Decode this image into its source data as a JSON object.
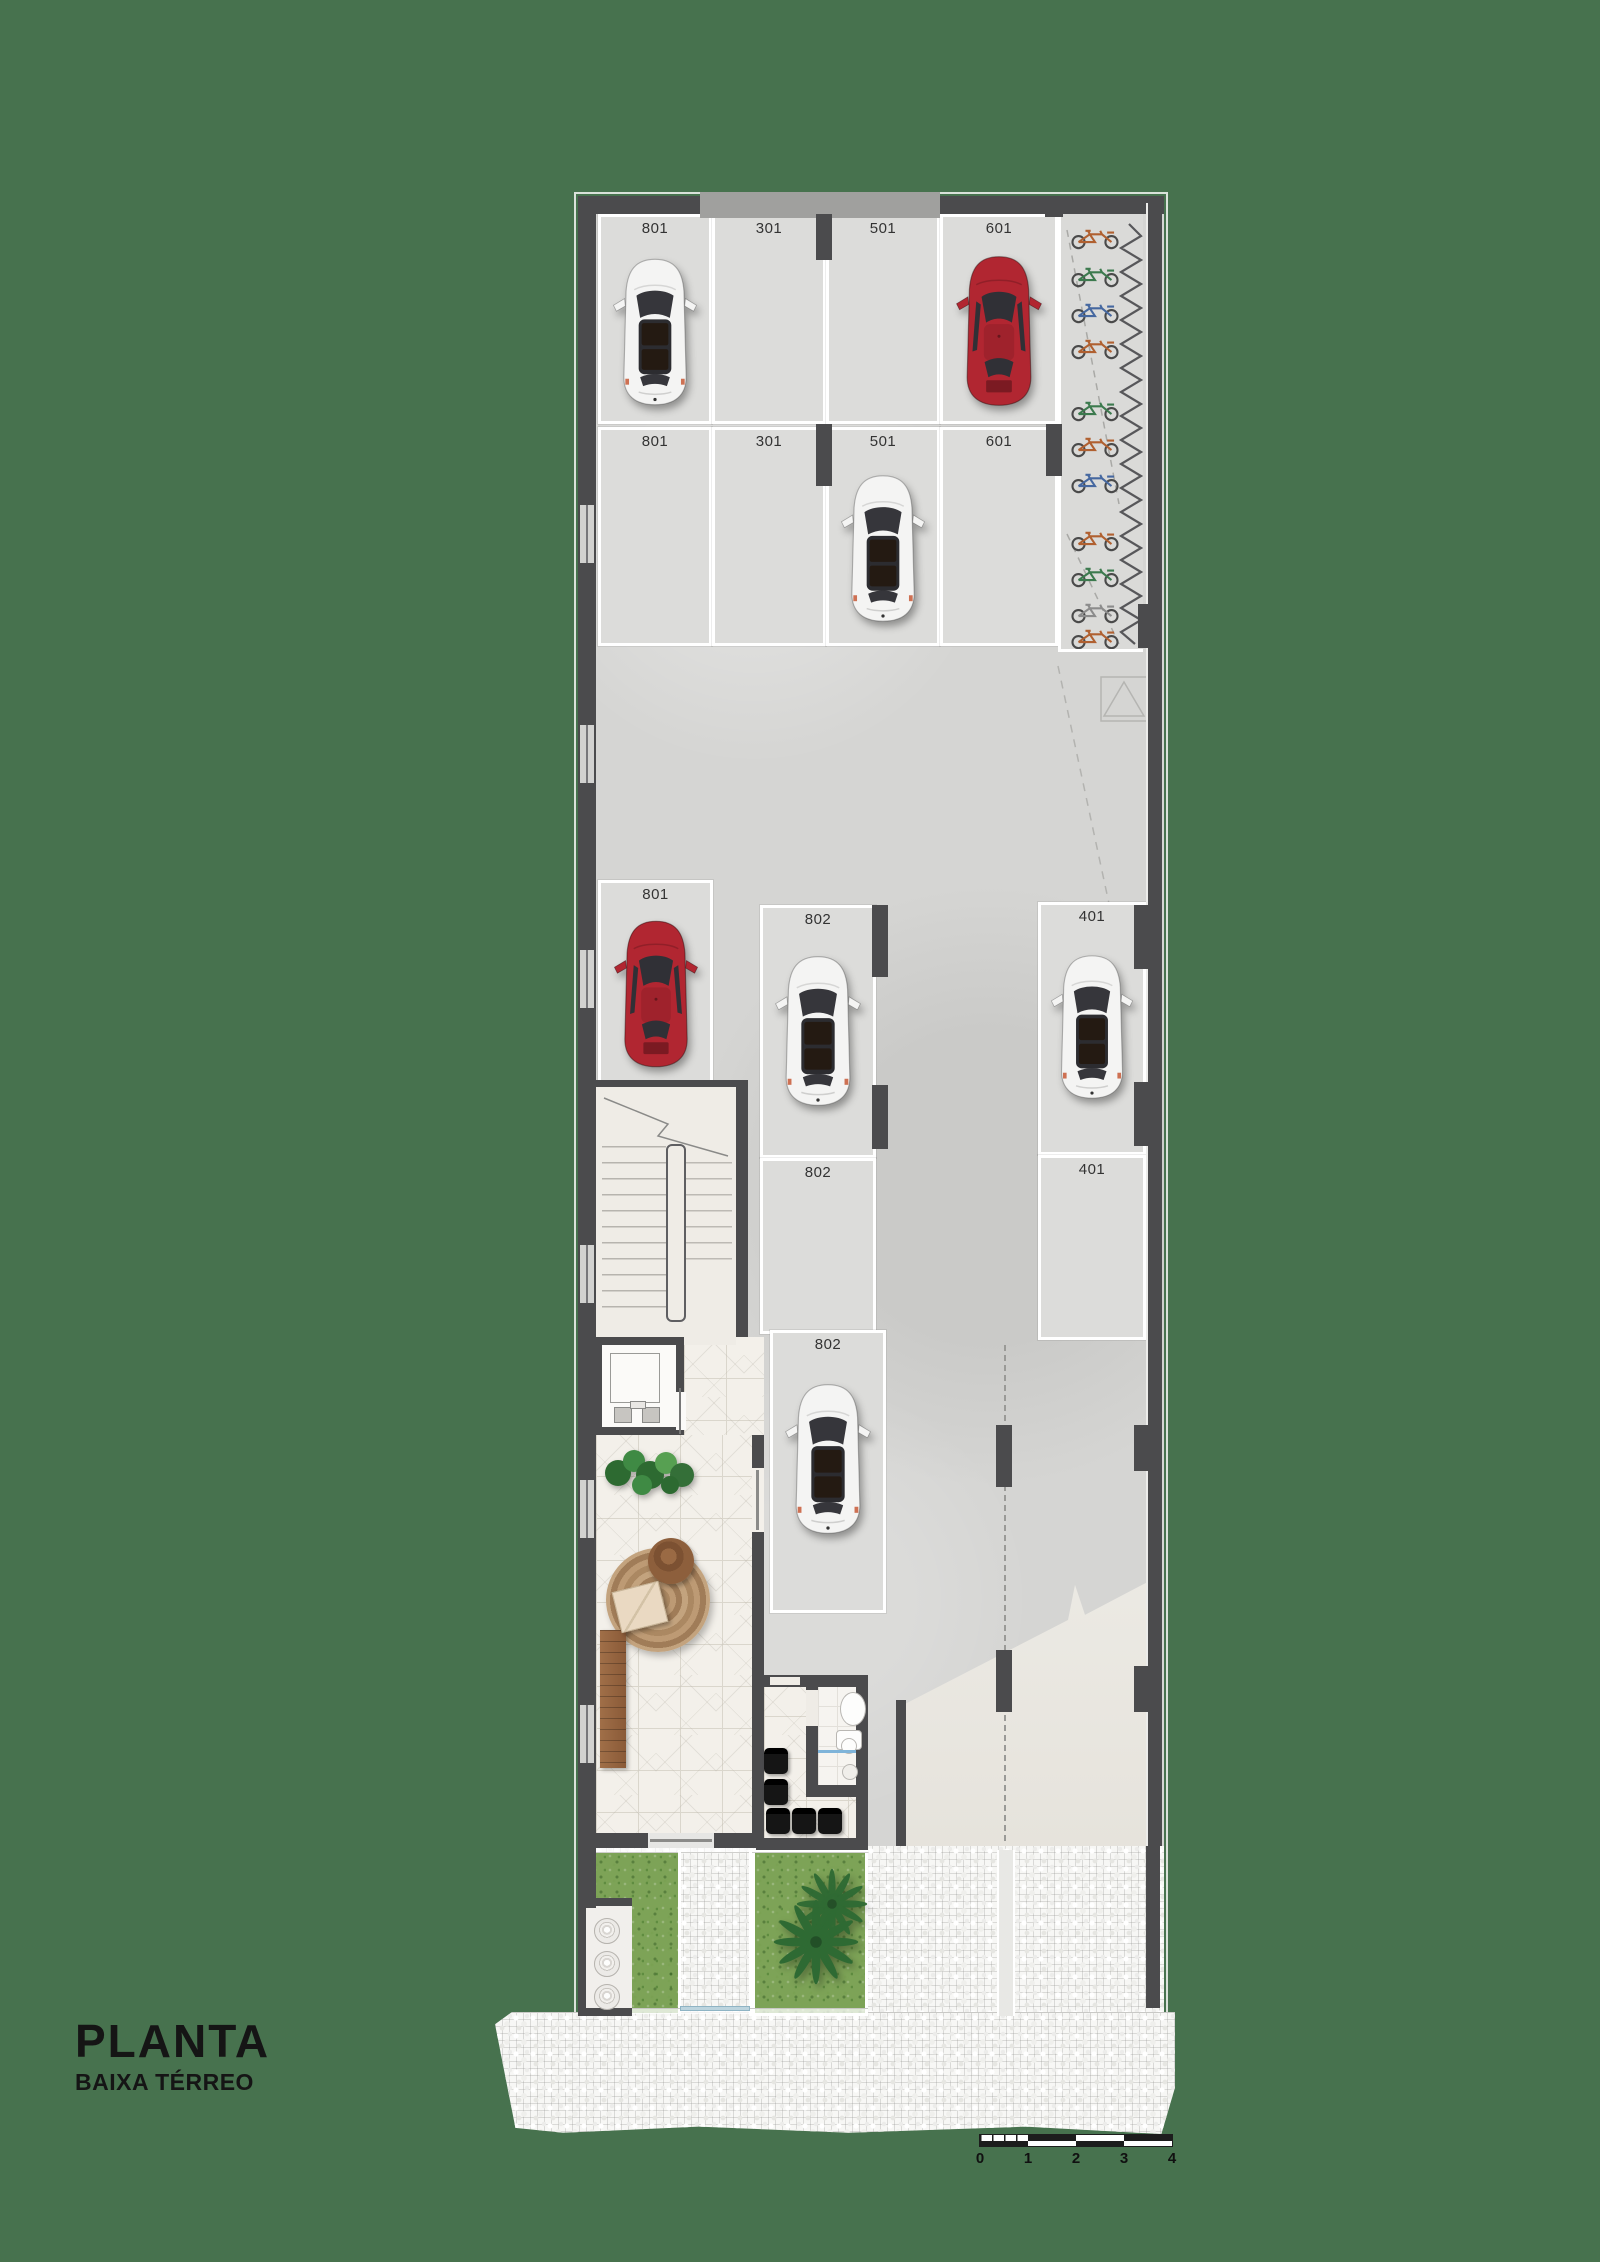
{
  "title": {
    "main": "PLANTA",
    "sub": "BAIXA TÉRREO"
  },
  "scale_bar": {
    "ticks": [
      "0",
      "1",
      "2",
      "3",
      "4"
    ]
  },
  "parking": {
    "top_row1": [
      "801",
      "301",
      "501",
      "601"
    ],
    "top_row2": [
      "801",
      "301",
      "501",
      "601"
    ],
    "middle": {
      "left801": "801",
      "a802": "802",
      "a401": "401",
      "b802": "802",
      "b401": "401",
      "c802": "802"
    }
  },
  "cars": [
    {
      "space": "801 top row 1",
      "color": "white"
    },
    {
      "space": "601 top row 1",
      "color": "red"
    },
    {
      "space": "501 top row 2",
      "color": "white"
    },
    {
      "space": "801 middle",
      "color": "red"
    },
    {
      "space": "802 middle A",
      "color": "white"
    },
    {
      "space": "401 middle A",
      "color": "white"
    },
    {
      "space": "802 middle C",
      "color": "white"
    }
  ],
  "icons": {
    "white_car": "car-top-white-icon",
    "red_car": "car-top-red-icon",
    "bicycle": "bicycle-icon",
    "bike_rack": "wave-bike-rack-icon",
    "palm": "palm-tree-icon",
    "plant": "plant-icon",
    "toilet": "toilet-icon",
    "sink": "sink-icon",
    "stairs": "stairs-icon",
    "elevator": "elevator-icon",
    "meters": "utility-meters-icon",
    "rug": "round-rug-icon",
    "bench": "wood-bench-icon"
  },
  "colors": {
    "background": "#47724E",
    "wall": "#4B4B4D",
    "floor_concrete": "#D5D5D3",
    "parking_space": "#DCDCDA",
    "tile_floor": "#F3F0EA",
    "grass": "#7DA357",
    "cobblestone": "#F7F7F5",
    "ramp": "#EAE8E2",
    "car_red": "#B12631",
    "car_white": "#F4F4F3",
    "label_text": "#333333",
    "title_text": "#151515"
  }
}
